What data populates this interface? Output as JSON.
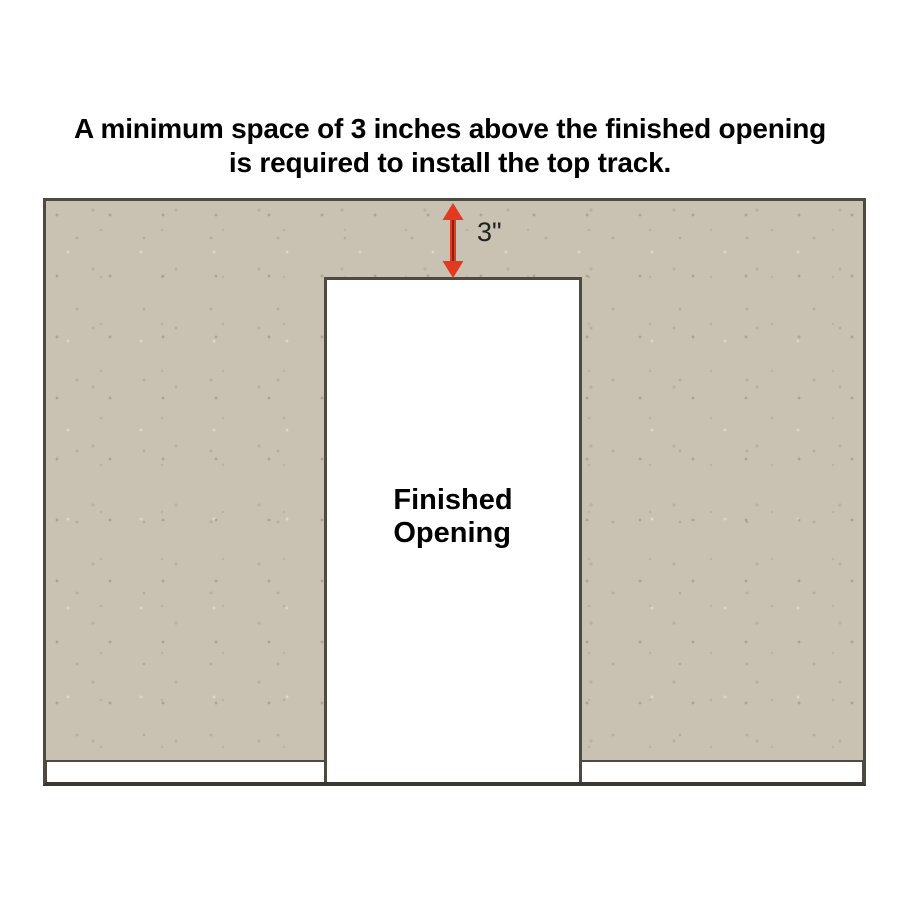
{
  "title": {
    "line1": "A minimum space of 3 inches above the finished opening",
    "line2": "is required to install the top track."
  },
  "diagram": {
    "dimension_label": "3\"",
    "opening_label": {
      "line1": "Finished",
      "line2": "Opening"
    },
    "colors": {
      "page_bg": "#ffffff",
      "wall_fill": "#c9c1b1",
      "wall_border": "#4e4a40",
      "floor_line": "#3a3830",
      "opening_fill": "#ffffff",
      "baseboard_fill": "#ffffff",
      "arrow": "#e23a20",
      "arrow_core": "#8c2012",
      "title_text": "#000000",
      "label_text": "#222222"
    }
  }
}
